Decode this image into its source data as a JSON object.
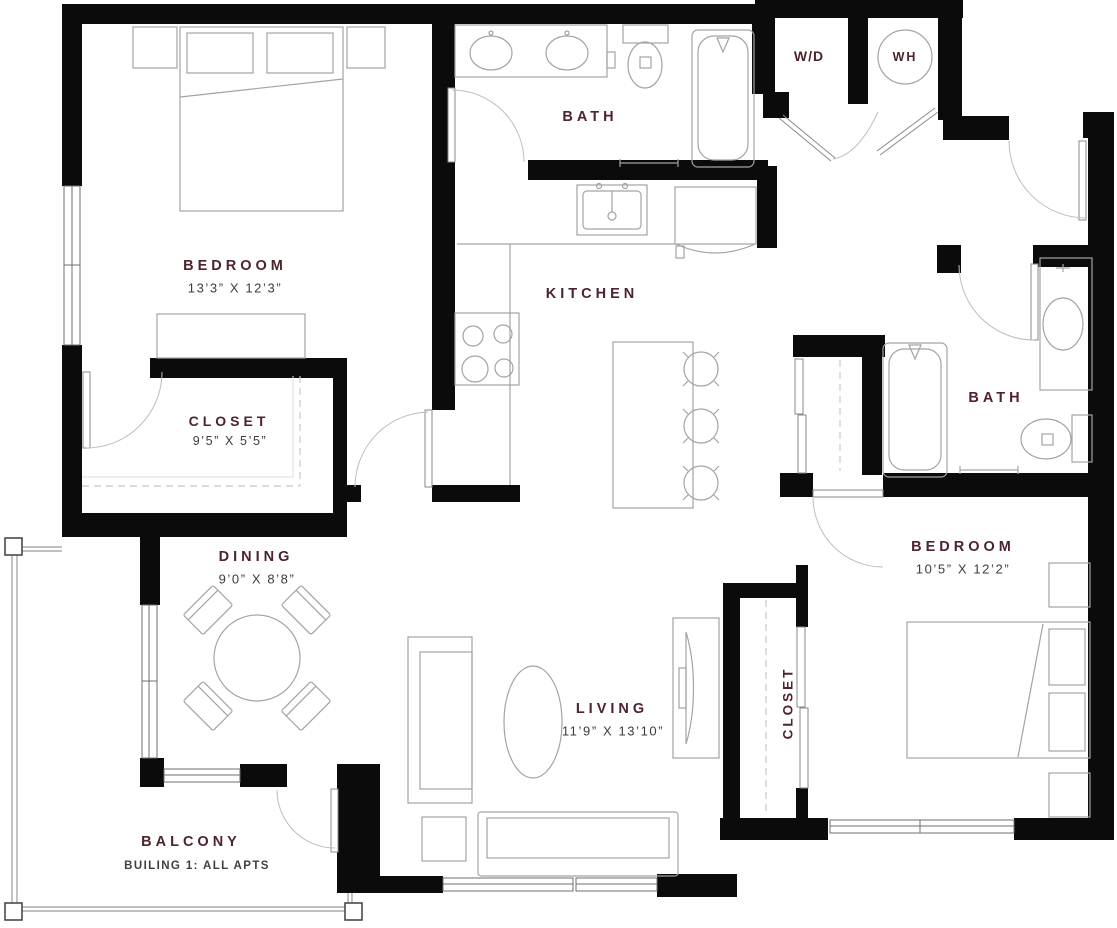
{
  "plan_title": "Two-bedroom apartment floor plan",
  "palette": {
    "wall_color": "#0b0b0b",
    "furniture_line_color": "#a3a3a3",
    "door_arc_color": "#bdbdbd",
    "room_label_color": "#4e232c",
    "dimension_text_color": "#3c3c3c",
    "background": "#ffffff"
  },
  "rooms": {
    "bedroom_1": {
      "label": "BEDROOM",
      "dims": "13’3” X 12’3”"
    },
    "closet_1": {
      "label": "CLOSET",
      "dims": "9’5” X 5’5”"
    },
    "bath_1": {
      "label": "BATH"
    },
    "kitchen": {
      "label": "KITCHEN"
    },
    "dining": {
      "label": "DINING",
      "dims": "9’0” X 8’8”"
    },
    "living": {
      "label": "LIVING",
      "dims": "11’9” X 13’10”"
    },
    "closet_2": {
      "label": "CLOSET"
    },
    "bath_2": {
      "label": "BATH"
    },
    "bedroom_2": {
      "label": "BEDROOM",
      "dims": "10’5” X 12’2”"
    },
    "balcony": {
      "label": "BALCONY",
      "note": "BUILING 1: ALL APTS"
    },
    "laundry": {
      "label": "W/D"
    },
    "water_heater": {
      "label": "WH"
    }
  }
}
